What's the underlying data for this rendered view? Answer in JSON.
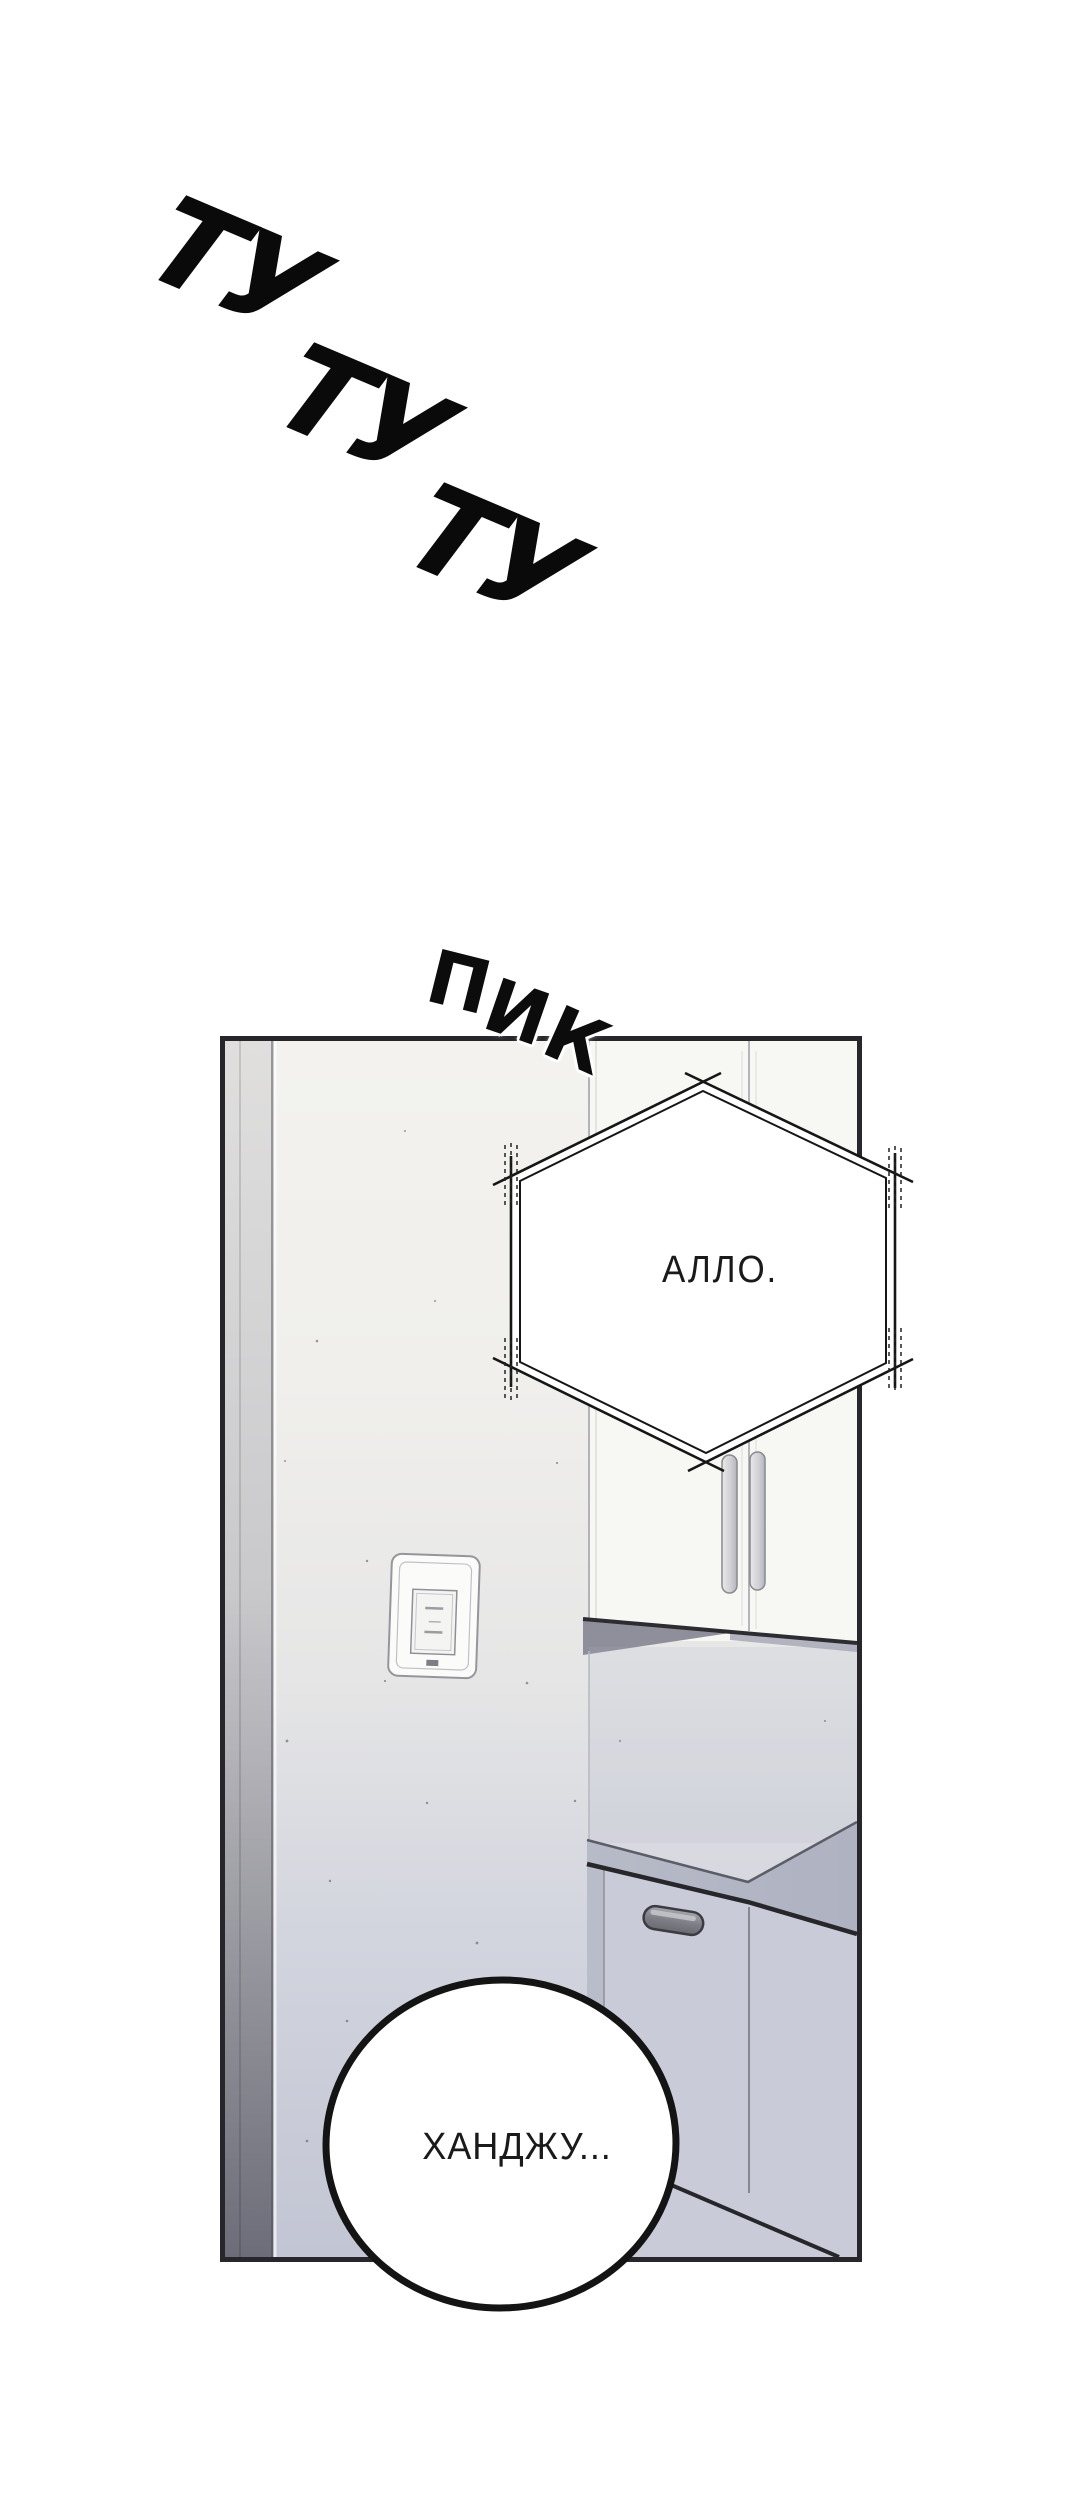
{
  "sfx": {
    "phone_ring": {
      "words": [
        "ТУ",
        "ТУ",
        "ТУ"
      ]
    },
    "beep": {
      "letters": [
        "П",
        "И",
        "К"
      ]
    }
  },
  "dialogue": {
    "hex_bubble": {
      "shape": "hexagon",
      "text": "АЛЛО."
    },
    "round_bubble": {
      "shape": "ellipse",
      "text": "ХАНДЖУ..."
    }
  },
  "colors": {
    "ink": "#111111",
    "panel_border": "#26262b",
    "bubble_fill": "#ffffff",
    "wall_top": "#f3f2ee",
    "wall_bottom": "#c2c5d3",
    "counter_top": "#b4b8c5",
    "counter_front": "#c9ccd8",
    "cabinet_face": "#f7f7f4",
    "door_frame_dark": "#6d6d79"
  }
}
